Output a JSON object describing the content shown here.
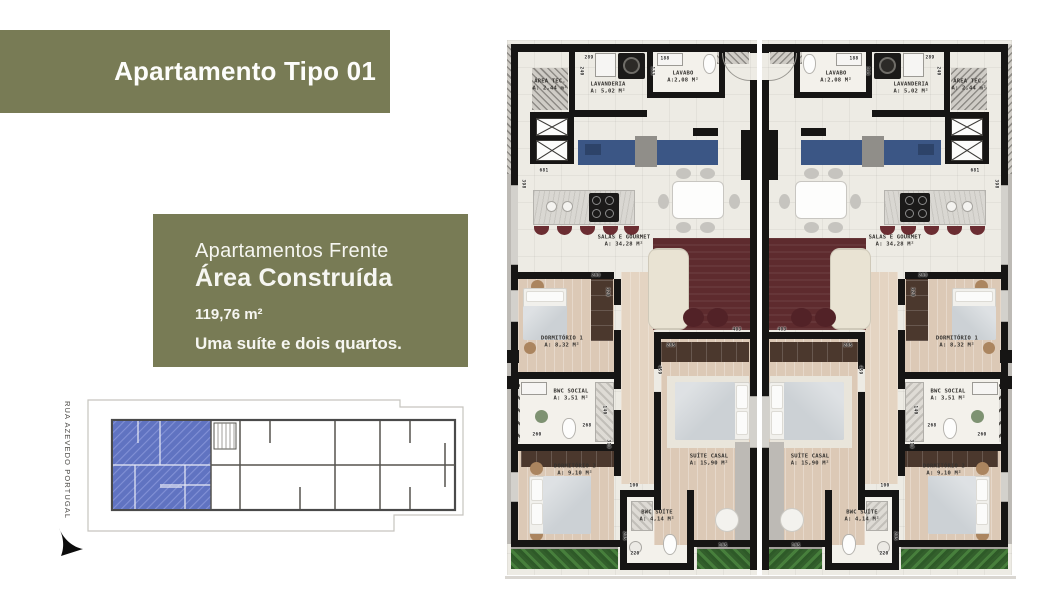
{
  "banner": {
    "title": "Apartamento Tipo 01"
  },
  "info_box": {
    "subtitle": "Apartamentos Frente",
    "title": "Área Construída",
    "area": "119,76 m²",
    "description": "Uma suíte e dois quartos."
  },
  "site_plan": {
    "street_label": "RUA AZEVEDO PORTUGAL"
  },
  "floor_plan": {
    "rooms": [
      {
        "name": "ÁREA TEC.",
        "area": "A: 2,44 m²",
        "x": 43,
        "y": 46
      },
      {
        "name": "LAVANDERIA",
        "area": "A: 5,02 M²",
        "x": 101,
        "y": 49
      },
      {
        "name": "LAVABO",
        "area": "A:2,08 M²",
        "x": 176,
        "y": 38
      },
      {
        "name": "SALAS E GOURMET",
        "area": "A: 34,28 M²",
        "x": 117,
        "y": 202
      },
      {
        "name": "DORMITÓRIO 1",
        "area": "A: 8,32 M²",
        "x": 55,
        "y": 303
      },
      {
        "name": "BWC SOCIAL",
        "area": "A: 3,51 M²",
        "x": 64,
        "y": 356
      },
      {
        "name": "SUÍTE CASAL",
        "area": "A: 15,90 M²",
        "x": 202,
        "y": 421
      },
      {
        "name": "DORMITÓRIO 2",
        "area": "A: 9,10 M²",
        "x": 68,
        "y": 431
      },
      {
        "name": "BWC SUÍTE",
        "area": "A: 4,14 M²",
        "x": 150,
        "y": 477
      }
    ],
    "dimensions": [
      {
        "t": "289",
        "x": 82,
        "y": 18
      },
      {
        "t": "240",
        "x": 74,
        "y": 31,
        "v": 1
      },
      {
        "t": "188",
        "x": 158,
        "y": 19
      },
      {
        "t": "133",
        "x": 145,
        "y": 31,
        "v": 1
      },
      {
        "t": "681",
        "x": 37,
        "y": 131
      },
      {
        "t": "398",
        "x": 16,
        "y": 144,
        "v": 1
      },
      {
        "t": "260",
        "x": 89,
        "y": 236
      },
      {
        "t": "320",
        "x": 100,
        "y": 252,
        "v": 1
      },
      {
        "t": "403",
        "x": 230,
        "y": 290
      },
      {
        "t": "285",
        "x": 164,
        "y": 306
      },
      {
        "t": "459",
        "x": 152,
        "y": 330,
        "v": 1
      },
      {
        "t": "140",
        "x": 97,
        "y": 370,
        "v": 1
      },
      {
        "t": "268",
        "x": 80,
        "y": 386
      },
      {
        "t": "260",
        "x": 30,
        "y": 395
      },
      {
        "t": "310",
        "x": 101,
        "y": 404,
        "v": 1
      },
      {
        "t": "100",
        "x": 127,
        "y": 446
      },
      {
        "t": "205",
        "x": 117,
        "y": 496,
        "v": 1
      },
      {
        "t": "220",
        "x": 128,
        "y": 514
      },
      {
        "t": "165",
        "x": 216,
        "y": 506
      }
    ]
  },
  "colors": {
    "accent_olive": "#787b55",
    "unit_highlight_blue": "#6073c1",
    "counter_blue": "#3b5685",
    "rug_maroon": "#5e2b2e"
  }
}
